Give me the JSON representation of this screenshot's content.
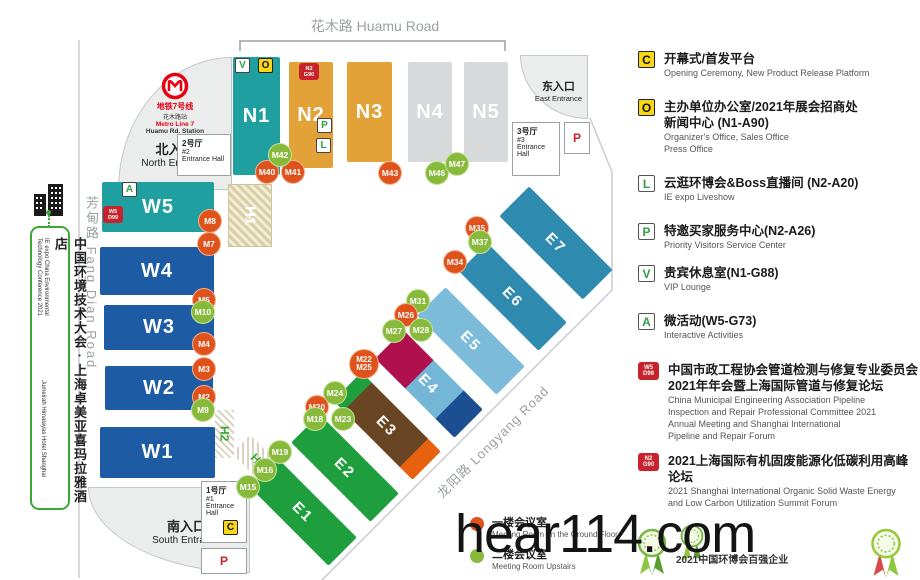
{
  "watermark": "hear114.com",
  "roads": {
    "top": "花木路 Huamu Road",
    "left": "芳甸路 Fang Dian Road",
    "diag": "龙阳路 Longyang Road"
  },
  "banner": {
    "cn": "中国环境技术大会 · 上海卓美亚喜玛拉雅酒店",
    "en_line1": "IE expo China Environmental",
    "en_line2": "Technology Conference 2021",
    "en_line3": "Jumeirah Himalayas Hotel Shanghai"
  },
  "metro": {
    "line_cn": "地铁7号线",
    "station_cn": "花木路站",
    "line_en": "Metro Line 7",
    "station_en": "Huamu Rd. Station"
  },
  "entrances": {
    "north_cn": "北入口",
    "north_en": "North Entrance",
    "south_cn": "南入口",
    "south_en": "South Entrance",
    "east_cn": "东入口",
    "east_en": "East Entrance"
  },
  "entrance_halls": {
    "h1": {
      "cn": "1号厅",
      "no": "#1",
      "en": "Entrance Hall"
    },
    "h2": {
      "cn": "2号厅",
      "no": "#2",
      "en": "Entrance Hall"
    },
    "h3": {
      "cn": "3号厅",
      "no": "#3",
      "en": "Entrance Hall"
    }
  },
  "parking_label": "P",
  "c_label": "C",
  "map": {
    "halls": [
      {
        "id": "N1",
        "x": 233,
        "y": 57,
        "w": 47,
        "h": 118,
        "bg": "#1f9fa0"
      },
      {
        "id": "N2",
        "x": 289,
        "y": 62,
        "w": 44,
        "h": 106,
        "bg": "#e3a238"
      },
      {
        "id": "N3",
        "x": 347,
        "y": 62,
        "w": 45,
        "h": 100,
        "bg": "#e3a238"
      },
      {
        "id": "N4",
        "x": 408,
        "y": 62,
        "w": 44,
        "h": 100,
        "bg": "#d7d9da"
      },
      {
        "id": "N5",
        "x": 464,
        "y": 62,
        "w": 44,
        "h": 100,
        "bg": "#d7d9da"
      },
      {
        "id": "W5",
        "x": 102,
        "y": 182,
        "w": 112,
        "h": 50,
        "bg": "#1f9fa0"
      },
      {
        "id": "W4",
        "x": 100,
        "y": 247,
        "w": 114,
        "h": 48,
        "bg": "#1d5ba4"
      },
      {
        "id": "W3",
        "x": 104,
        "y": 305,
        "w": 110,
        "h": 45,
        "bg": "#1d5ba4"
      },
      {
        "id": "W2",
        "x": 105,
        "y": 366,
        "w": 108,
        "h": 44,
        "bg": "#1d5ba4"
      },
      {
        "id": "W1",
        "x": 100,
        "y": 427,
        "w": 115,
        "h": 51,
        "bg": "#1d5ba4"
      }
    ],
    "e_halls": [
      {
        "id": "E1",
        "cx": 303,
        "cy": 512,
        "len": 112,
        "wid": 40,
        "bg": "#1f9e3d"
      },
      {
        "id": "E2",
        "cx": 345,
        "cy": 468,
        "len": 112,
        "wid": 40,
        "bg": "#1f9e3d"
      },
      {
        "id": "E3",
        "cx": 387,
        "cy": 426,
        "len": 112,
        "wid": 40,
        "bg": "linear-gradient(90deg,#1f9e3d 0 13%,#6a4524 13% 84%,#e8610e 84% 100%)"
      },
      {
        "id": "E4",
        "cx": 429,
        "cy": 384,
        "len": 112,
        "wid": 40,
        "bg": "linear-gradient(90deg,#b0104d 0 38%,#74b6d6 38% 76%,#1c4f92 76% 100%)"
      },
      {
        "id": "E5",
        "cx": 471,
        "cy": 341,
        "len": 112,
        "wid": 40,
        "bg": "#7cbbd9"
      },
      {
        "id": "E6",
        "cx": 513,
        "cy": 297,
        "len": 112,
        "wid": 40,
        "bg": "#2e8aae"
      },
      {
        "id": "E7",
        "cx": 556,
        "cy": 243,
        "len": 118,
        "wid": 42,
        "bg": "#2e8aae"
      }
    ],
    "service_halls": [
      {
        "id": "H1",
        "kind": "tan"
      },
      {
        "id": "H2",
        "kind": "gray"
      },
      {
        "id": "H3",
        "kind": "gray-diag"
      }
    ],
    "markers": [
      {
        "l": "M40",
        "c": "o",
        "x": 267,
        "y": 172
      },
      {
        "l": "M41",
        "c": "o",
        "x": 293,
        "y": 172
      },
      {
        "l": "M42",
        "c": "g",
        "x": 280,
        "y": 155
      },
      {
        "l": "M43",
        "c": "o",
        "x": 390,
        "y": 173
      },
      {
        "l": "M46",
        "c": "g",
        "x": 437,
        "y": 173
      },
      {
        "l": "M47",
        "c": "g",
        "x": 457,
        "y": 164
      },
      {
        "l": "M8",
        "c": "o",
        "x": 210,
        "y": 221
      },
      {
        "l": "M7",
        "c": "o",
        "x": 209,
        "y": 244
      },
      {
        "l": "M5",
        "c": "o",
        "x": 204,
        "y": 300
      },
      {
        "l": "M10",
        "c": "g",
        "x": 203,
        "y": 312
      },
      {
        "l": "M4",
        "c": "o",
        "x": 204,
        "y": 344
      },
      {
        "l": "M3",
        "c": "o",
        "x": 204,
        "y": 369
      },
      {
        "l": "M2",
        "c": "o",
        "x": 204,
        "y": 397
      },
      {
        "l": "M9",
        "c": "g",
        "x": 203,
        "y": 410
      },
      {
        "l": "M35",
        "c": "o",
        "x": 477,
        "y": 228
      },
      {
        "l": "M37",
        "c": "g",
        "x": 480,
        "y": 242
      },
      {
        "l": "M34",
        "c": "o",
        "x": 455,
        "y": 262
      },
      {
        "l": "M31",
        "c": "g",
        "x": 418,
        "y": 301
      },
      {
        "l": "M26",
        "c": "o",
        "x": 406,
        "y": 315
      },
      {
        "l": "M27",
        "c": "g",
        "x": 394,
        "y": 331
      },
      {
        "l": "M28",
        "c": "g",
        "x": 421,
        "y": 330
      },
      {
        "l": "M22",
        "l2": "M25",
        "c": "o",
        "x": 364,
        "y": 364
      },
      {
        "l": "M24",
        "c": "g",
        "x": 335,
        "y": 393
      },
      {
        "l": "M20",
        "c": "o",
        "x": 317,
        "y": 407
      },
      {
        "l": "M18",
        "c": "g",
        "x": 315,
        "y": 419
      },
      {
        "l": "M23",
        "c": "g",
        "x": 343,
        "y": 419
      },
      {
        "l": "M19",
        "c": "g",
        "x": 280,
        "y": 452
      },
      {
        "l": "M16",
        "c": "g",
        "x": 265,
        "y": 470
      },
      {
        "l": "M15",
        "c": "g",
        "x": 248,
        "y": 487
      }
    ],
    "badges": [
      {
        "t": "V",
        "s": "green",
        "x": 235,
        "y": 58,
        "name": "vip-lounge-marker"
      },
      {
        "t": "O",
        "s": "yellow",
        "x": 258,
        "y": 58,
        "name": "organizer-office-marker"
      },
      {
        "t1": "N2",
        "t2": "G90",
        "s": "red",
        "x": 299,
        "y": 63,
        "name": "forum-n2-g90-marker"
      },
      {
        "t": "P",
        "s": "green",
        "x": 317,
        "y": 118,
        "name": "priority-visitors-marker"
      },
      {
        "t": "L",
        "s": "green",
        "x": 316,
        "y": 138,
        "name": "liveshow-marker"
      },
      {
        "t": "A",
        "s": "green",
        "x": 122,
        "y": 182,
        "name": "interactive-activities-marker"
      },
      {
        "t1": "W5",
        "t2": "D99",
        "s": "red",
        "x": 103,
        "y": 206,
        "name": "forum-w5-d99-marker"
      }
    ]
  },
  "legend": {
    "items": [
      {
        "icon": "C",
        "style": "yellow",
        "title": [
          "开幕式/首发平台"
        ],
        "sub": [
          "Opening Ceremony, New Product Release Platform"
        ]
      },
      {
        "icon": "O",
        "style": "yellow",
        "title": [
          "主办单位办公室/2021年展会招商处",
          "新闻中心 (N1-A90)"
        ],
        "sub": [
          "Organizer's Office, Sales Office",
          "Press Office"
        ]
      },
      {
        "icon": "L",
        "style": "green",
        "title": [
          "云逛环博会&Boss直播间 (N2-A20)"
        ],
        "sub": [
          "IE expo Liveshow"
        ]
      },
      {
        "icon": "P",
        "style": "green",
        "title": [
          "特邀买家服务中心(N2-A26)"
        ],
        "sub": [
          "Priority Visitors Service Center"
        ]
      },
      {
        "icon": "V",
        "style": "green",
        "title": [
          "贵宾休息室(N1-G88)"
        ],
        "sub": [
          "VIP Lounge"
        ]
      },
      {
        "icon": "A",
        "style": "green",
        "title": [
          "微活动(W5-G73)"
        ],
        "sub": [
          "Interactive Activities"
        ]
      },
      {
        "icon": "W5",
        "icon2": "D99",
        "style": "red",
        "title": [
          "中国市政工程协会管道检测与修复专业委员会",
          "2021年年会暨上海国际管道与修复论坛"
        ],
        "sub": [
          "China Municipal Engineering Association Pipeline",
          "Inspection and Repair Professional Committee 2021",
          "Annual Meeting and Shanghai International",
          "Pipeline and Repair Forum"
        ]
      },
      {
        "icon": "N2",
        "icon2": "G90",
        "style": "red",
        "title": [
          "2021上海国际有机固废能源化低碳利用高峰论坛"
        ],
        "sub": [
          "2021 Shanghai International Organic Solid Waste Energy",
          "and Low Carbon Utilization Summit Forum"
        ]
      }
    ]
  },
  "floor_legend": [
    {
      "color": "#e0521c",
      "cn": "一楼会议室",
      "en": "Meeting Room on the Ground Floor"
    },
    {
      "color": "#87ba3b",
      "cn": "二楼会议室",
      "en": "Meeting Room Upstairs"
    }
  ],
  "award_text": "2021中国环博会百强企业"
}
